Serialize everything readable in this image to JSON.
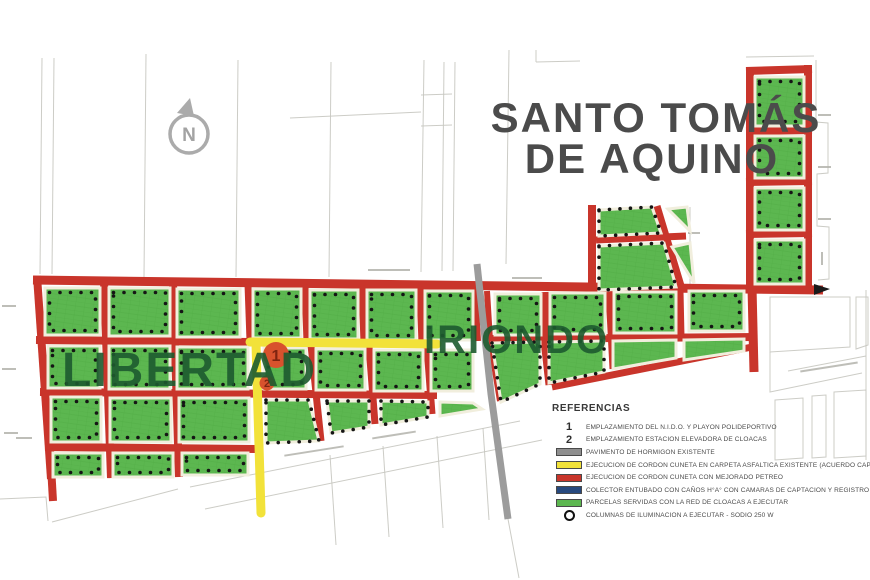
{
  "map": {
    "title_line1": "SANTO TOMÁS",
    "title_line2": "DE AQUINO",
    "district_libertad": "LIBERTAD",
    "district_iriondo": "IRIONDO",
    "north_label": "N",
    "marker1_label": "1",
    "marker2_label": "2"
  },
  "legend": {
    "title": "REFERENCIAS",
    "items": [
      {
        "symbol": "number",
        "key": "1",
        "label": "EMPLAZAMIENTO DEL N.I.D.O. Y PLAYON POLIDEPORTIVO"
      },
      {
        "symbol": "number",
        "key": "2",
        "label": "EMPLAZAMIENTO ESTACION ELEVADORA DE CLOACAS"
      },
      {
        "symbol": "swatch",
        "color": "#8f8f8f",
        "label": "PAVIMENTO DE HORMIGON EXISTENTE"
      },
      {
        "symbol": "swatch",
        "color": "#f2e23a",
        "label": "EJECUCION DE CORDON CUNETA EN CARPETA ASFALTICA EXISTENTE (ACUERDO CAPITAL)"
      },
      {
        "symbol": "swatch",
        "color": "#c9352b",
        "label": "EJECUCION DE CORDON CUNETA CON MEJORADO PETREO"
      },
      {
        "symbol": "swatch",
        "color": "#27497e",
        "label": "COLECTOR ENTUBADO CON CAÑOS H°A° CON CAMARAS DE CAPTACION Y REGISTRO"
      },
      {
        "symbol": "swatch",
        "color": "#5cb750",
        "label": "PARCELAS SERVIDAS CON LA RED DE CLOACAS A EJECUTAR"
      },
      {
        "symbol": "circle",
        "label": "COLUMNAS DE ILUMINACION A EJECUTAR - SODIO 250 W"
      }
    ]
  },
  "colors": {
    "street_red": "#c9352b",
    "street_yellow": "#f2e23a",
    "street_gray": "#9c9c9c",
    "parcel_green": "#5cb750",
    "collector_navy": "#27497e",
    "marker_orange": "#d8522d",
    "district_text_green": "#1d5b2f",
    "title_gray": "#4b4b4b"
  }
}
